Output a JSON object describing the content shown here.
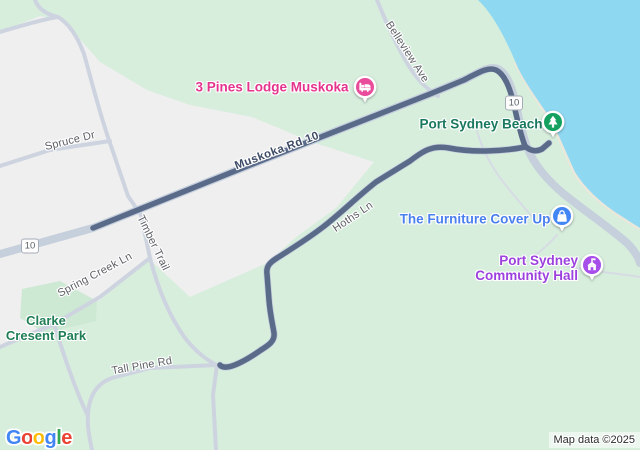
{
  "logo": {
    "letters": [
      "G",
      "o",
      "o",
      "g",
      "l",
      "e"
    ],
    "styles": [
      "color:#4285F4",
      "color:#EA4335",
      "color:#FBBC05",
      "color:#4285F4",
      "color:#34A853",
      "color:#EA4335"
    ]
  },
  "attribution": "Map data ©2025",
  "shields": [
    {
      "label": "10"
    },
    {
      "label": "10"
    }
  ],
  "road_labels": [
    {
      "name": "Spruce Dr"
    },
    {
      "name": "Muskoka Rd 10"
    },
    {
      "name": "Timber Trail"
    },
    {
      "name": "Spring Creek Ln"
    },
    {
      "name": "Tall Pine Rd"
    },
    {
      "name": "Hoths Ln"
    },
    {
      "name": "Belleview Ave"
    }
  ],
  "pois": [
    {
      "label": "3 Pines Lodge Muskoka",
      "category": "lodging",
      "color": "#E84C9B",
      "text_color": "#E5348D"
    },
    {
      "label": "Port Sydney Beach",
      "category": "park-beach",
      "color": "#14A15F",
      "text_color": "#18795E"
    },
    {
      "label": "The Furniture Cover Up",
      "category": "shopping",
      "color": "#4285F4",
      "text_color": "#4A7FEF"
    },
    {
      "label": "Port Sydney Community Hall",
      "lines": [
        "Port Sydney",
        "Community Hall"
      ],
      "category": "civic-building",
      "color": "#A64DEA",
      "text_color": "#9C41DE"
    }
  ],
  "park_label": {
    "lines": [
      "Clarke",
      "Cresent Park"
    ],
    "text_color": "#1F7E55"
  },
  "colors": {
    "water": "#8FD8F1",
    "land_green": "#D7EEDD",
    "land_urban": "#EFEFEF",
    "park_green": "#CDE9D4",
    "beach_strip": "#EAE7DB",
    "road_major": "#C6CFDC",
    "road_minor": "#CDD4E0",
    "route": "#5A6B8A"
  }
}
